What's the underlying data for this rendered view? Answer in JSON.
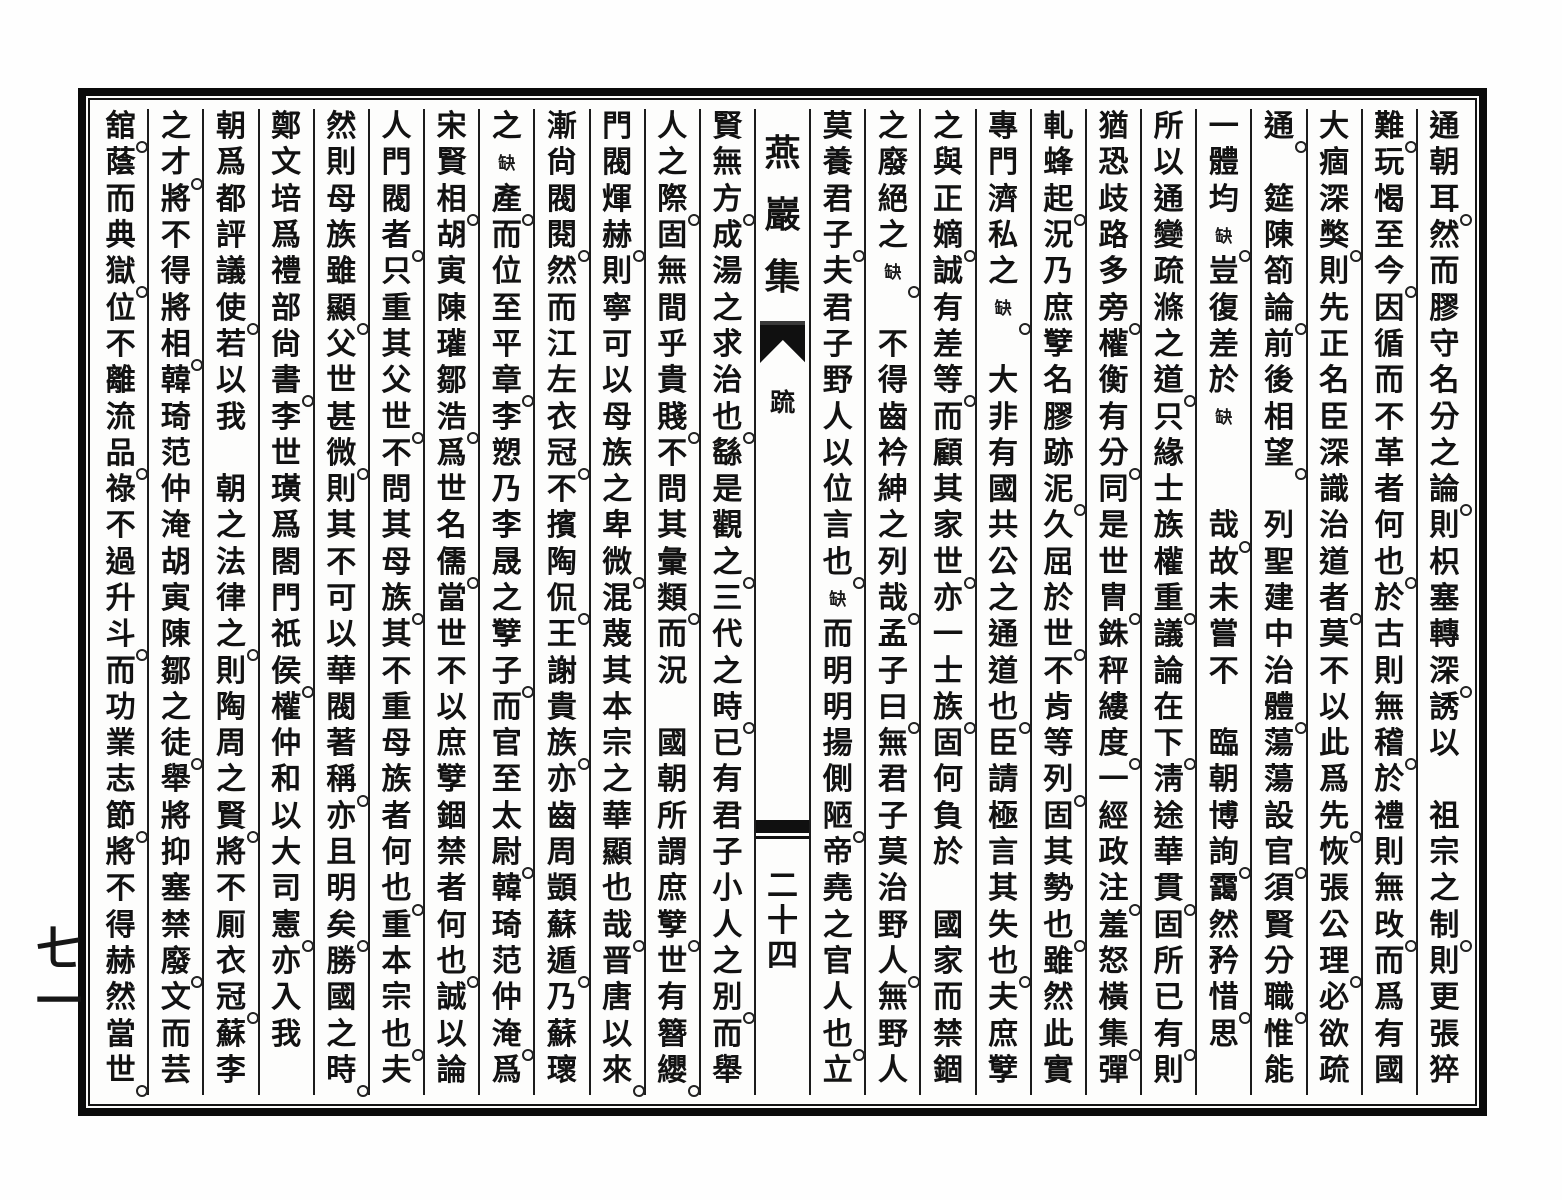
{
  "document": {
    "book_title": "燕巖集",
    "section_label": "䟽",
    "folio_page_number": "二十四",
    "margin_page_number": "七一",
    "lacuna_marker": "缺",
    "ink_color": "#121212",
    "paper_color": "#fdfdfc"
  },
  "text": {
    "right_columns": [
      "通朝耳。然而膠守名分之論。則枳塞轉深。誘以　祖宗之制。則更張猝",
      "難。玩愒至今。因循而不革者何也。於古則無稽。於禮則無攺。而爲有國",
      "大痼深獘。則先正名臣深識治道者。莫不以此爲先。恢張公理。必欲疏",
      "通。　筵陳箚論。前後相望。　列聖建中治體。蕩蕩設官。須賢分職。惟能",
      "一體均缺。豈復差於缺　　哉。故未嘗不　臨朝博詢。靄然矜惜。思",
      "所以通變疏滌之道。只緣士族權重。議論在下。淸途華貫。固所已有。則",
      "猶恐歧路多旁。權衡有分。同是世冑。銖秤縷度。一經政注。羞怒橫集。彈",
      "軋蜂起。況乃庶孼名膠跡泥。久屈於世。不肯等列。固其勢也。雖然此實",
      "專門濟私之缺。　大非有國共公之通道也。臣請極言其失也。夫庶孼",
      "之與正嫡。誠有差等。而顧其家世。亦一士族。固何負於　國家而禁錮",
      "之廢絕之缺。　不得齒衿紳之列哉。孟子曰。無君子莫治野人。無野人",
      "莫養君子。夫君子野人以位言也。缺而明明揚側陋。帝堯之官人也。立"
    ],
    "left_columns": [
      "賢無方。成湯之求治也。繇是觀之。三代之時。已有君子小人之別。而舉",
      "人之際。固無間乎貴賤。不問其彙類。而況　國朝所謂庶孼。世有簪纓。",
      "門閥煇赫。則寧可以母族之卑微。混蔑其本宗之華顯也哉。晋唐以來。",
      "漸尙閥閱。然而江左衣冠。不擯陶侃。王謝貴族。亦齒周顗蘇遁。乃蘇瓌",
      "之缺產。而位至平章。李愬乃李晟之孼子。而官至太尉。韓琦范仲淹。爲",
      "宋賢相。胡寅陳瓘鄒浩。爲世名儒。當世不以庶孼錮禁者何也。誠以論",
      "人門閥者。只重其父世。不問其母族。其不重母族者何也。重本宗也。夫",
      "然則母族雖顯。父世甚微。則其不可以華閥著稱。亦且明矣。勝國之時。",
      "鄭文培爲禮部尙書。李世璜爲閤門祇侯。權仲和以大司憲。亦入我",
      "朝爲都評議使。若以我　朝之法律之。則陶周之賢。將不厠衣冠。蘇李",
      "之才。將不得將相。韓琦范仲淹胡寅陳鄒之徒。舉將抑塞禁廢。文而芸",
      "舘。蔭而典獄。位不離流品。祿不過升斗。而功業志節。將不得赫然當世。"
    ]
  }
}
